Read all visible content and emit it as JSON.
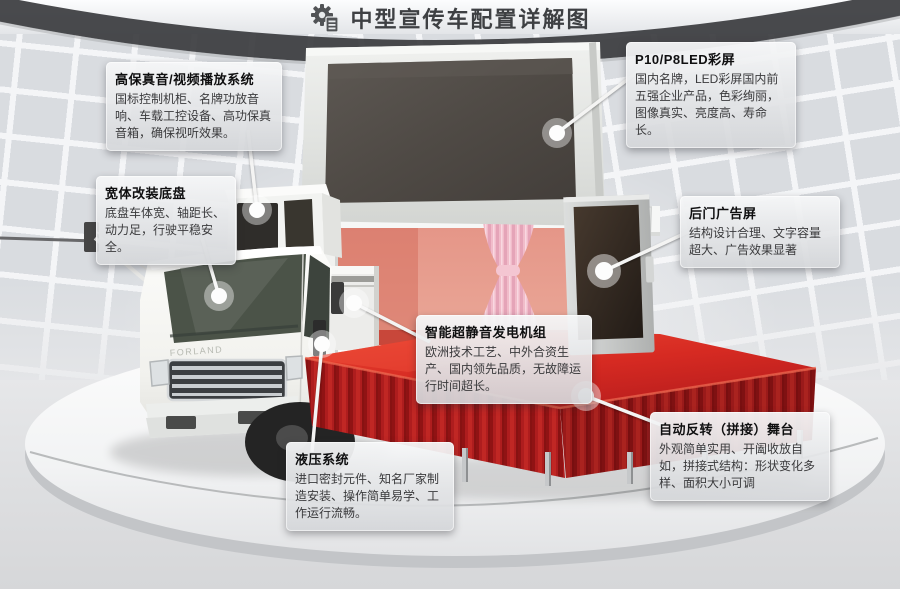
{
  "title": {
    "text": "中型宣传车配置详解图",
    "icon": "gear-document-icon"
  },
  "scene": {
    "truck_brand": "FORLAND",
    "parts": [
      "led-main-screen",
      "truck-cab",
      "speaker-av-box",
      "generator-box",
      "interior-curtain",
      "rear-door-screen",
      "red-stage",
      "round-platform"
    ]
  },
  "colors": {
    "stage_red": "#c02020",
    "stage_red_light": "#e03428",
    "wall_panel": "#d9dce0",
    "dark_band": "#3b3c3f",
    "screen_dark": "#534e49",
    "callout_bg": "#e9eaec"
  },
  "callouts": [
    {
      "id": "hifi-audio",
      "title": "高保真音/视频播放系统",
      "body": "国标控制机柜、名牌功放音响、车载工控设备、高功保真音箱，确保视听效果。"
    },
    {
      "id": "wide-chassis",
      "title": "宽体改装底盘",
      "body": "底盘车体宽、轴距长、动力足，行驶平稳安全。"
    },
    {
      "id": "led-color-screen",
      "title": "P10/P8LED彩屏",
      "body": "国内名牌，LED彩屏国内前五强企业产品，色彩绚丽，图像真实、亮度高、寿命长。"
    },
    {
      "id": "rear-door-ad-screen",
      "title": "后门广告屏",
      "body": "结构设计合理、文字容量超大、广告效果显著"
    },
    {
      "id": "silent-generator",
      "title": "智能超静音发电机组",
      "body": "欧洲技术工艺、中外合资生产、国内领先品质，无故障运行时间超长。"
    },
    {
      "id": "hydraulic-system",
      "title": "液压系统",
      "body": "进口密封元件、知名厂家制造安装、操作简单易学、工作运行流畅。"
    },
    {
      "id": "folding-stage",
      "title": "自动反转（拼接）舞台",
      "body": "外观简单实用、开阖收放自如，拼接式结构：形状变化多样、面积大小可调"
    }
  ]
}
